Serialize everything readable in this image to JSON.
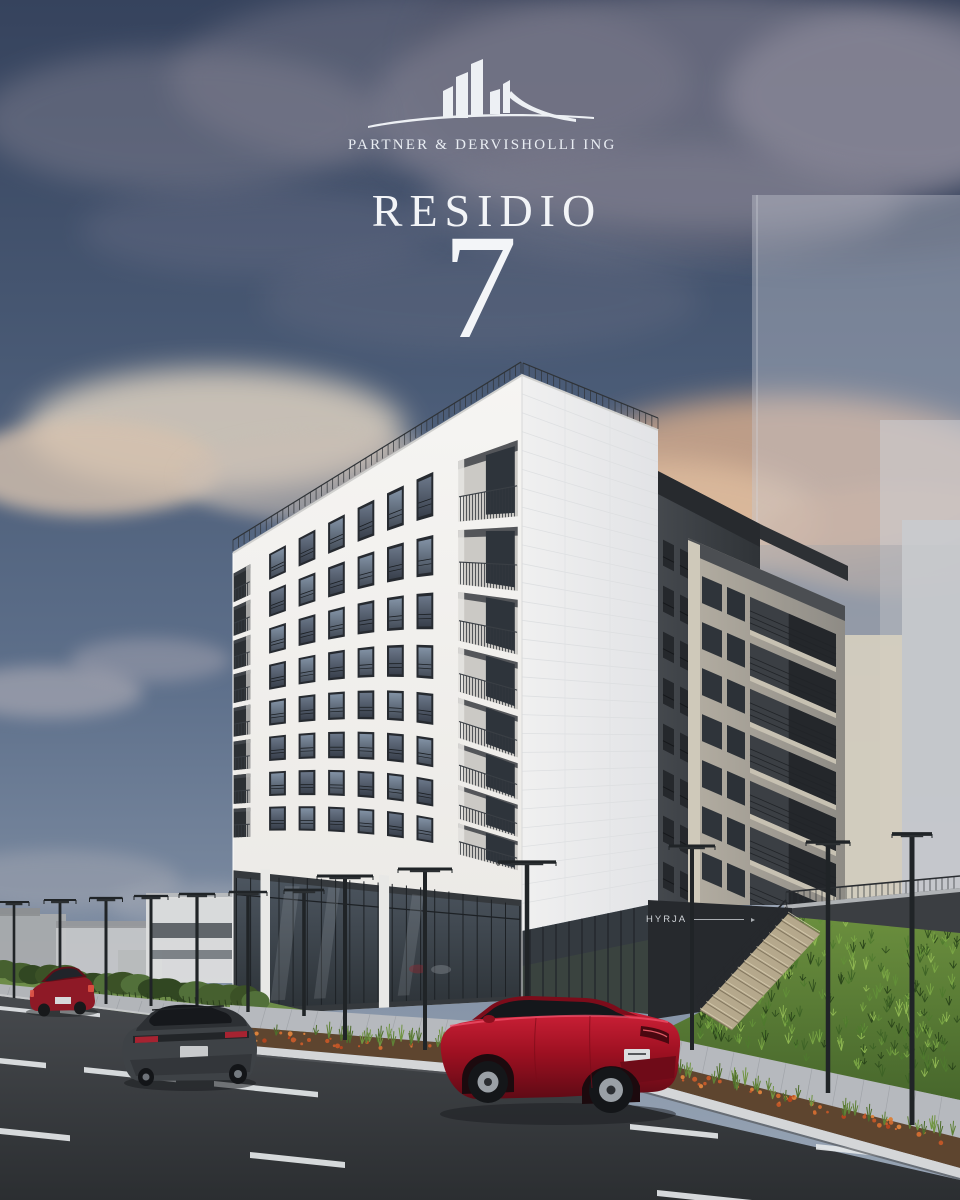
{
  "branding": {
    "company": "PARTNER & DERVISHOLLI ING",
    "project_name": "RESIDIO",
    "project_number": "7",
    "logo_icon": "skyline-buildings-swoosh-icon"
  },
  "building_signs": {
    "entrance_label": "HYRJA"
  },
  "palette": {
    "sky_top": "#36435d",
    "sky_horizon": "#98a5b5",
    "cloud_cream": "#dcd0c0",
    "cloud_peach": "#d9ad8c",
    "facade_white": "#f4f3f1",
    "facade_side": "#eaebec",
    "window_glass": "#49525f",
    "window_frame": "#262a30",
    "storefront_dark": "#35393d",
    "entrance_wall_dark": "#26292d",
    "tower_dark": "#3d4145",
    "midrise_gray": "#a8a49b",
    "grass_green": "#5d8036",
    "flowers_orange": "#c6602e",
    "road_asphalt": "#3a3d41",
    "lane_marking": "#e4e7e9",
    "sidewalk_gray": "#b6b9be",
    "stairs_beige": "#b5a88c",
    "car_far_red": "#8e1926",
    "car_suv_dark": "#3e4246",
    "car_mazda_red": "#a01526",
    "text_light": "#f1f3f6"
  }
}
